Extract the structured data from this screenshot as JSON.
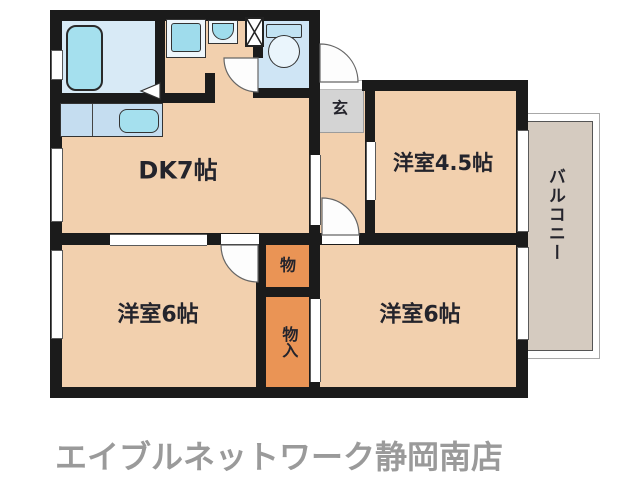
{
  "floorplan": {
    "footer_text": "エイブルネットワーク静岡南店",
    "rooms": {
      "dk": "DK7帖",
      "room_45": "洋室4.5帖",
      "room_6_left": "洋室6帖",
      "room_6_right": "洋室6帖",
      "entrance": "玄",
      "storage": "物",
      "closet": "物入",
      "balcony": "バルコニー"
    },
    "fixtures": [
      "bathtub",
      "washing-machine",
      "washbasin",
      "pipe-shaft",
      "toilet",
      "kitchen-counter",
      "kitchen-sink"
    ],
    "colors": {
      "wall": "#1b1b1b",
      "room_floor": "#f2d0ae",
      "wet_floor": "#d8eaf6",
      "toilet_floor": "#cfe5f5",
      "fixture_blue": "#a5e0ee",
      "counter_blue": "#c5ddf0",
      "storage_orange": "#ea9455",
      "entrance_gray": "#d4d4d4",
      "balcony_beige": "#d5cbc0",
      "footer_gray": "#9a9a9a"
    }
  }
}
